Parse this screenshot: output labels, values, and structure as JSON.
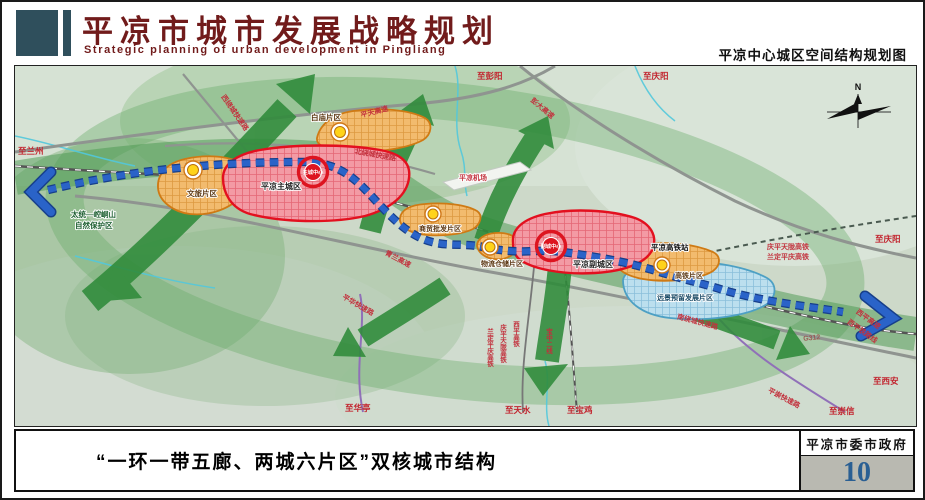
{
  "header": {
    "title": "平凉市城市发展战略规划",
    "subtitle_en": "Strategic planning of urban development in Pingliang",
    "right_caption": "平凉中心城区空间结构规划图"
  },
  "footer": {
    "caption": "“一环一带五廊、两城六片区”双核城市结构",
    "agency": "平凉市委市政府",
    "page_number": "10"
  },
  "map": {
    "compass_n": "N",
    "districts": [
      {
        "id": "baimiao",
        "label": "白庙片区",
        "type": "orange"
      },
      {
        "id": "wenlv",
        "label": "文旅片区",
        "type": "orange"
      },
      {
        "id": "zhucheng",
        "label": "平凉主城区",
        "type": "red"
      },
      {
        "id": "shangmao",
        "label": "商贸批发片区",
        "type": "orange"
      },
      {
        "id": "wuliu",
        "label": "物流仓储片区",
        "type": "orange"
      },
      {
        "id": "fucheng",
        "label": "平凉副城区",
        "type": "red"
      },
      {
        "id": "gaotie",
        "label": "高铁片区",
        "type": "orange"
      },
      {
        "id": "yuanjing",
        "label": "远景预留发展片区",
        "type": "blue"
      }
    ],
    "centers": [
      {
        "id": "main-core",
        "label": "主城中心"
      },
      {
        "id": "sub-core",
        "label": "副城中心"
      }
    ],
    "roads": [
      {
        "id": "xiraocheng",
        "label": "西绕城快速路"
      },
      {
        "id": "pingtian",
        "label": "平天高速"
      },
      {
        "id": "beiraocheng",
        "label": "北绕城快速路"
      },
      {
        "id": "pengda",
        "label": "彭大高速"
      },
      {
        "id": "qinglan",
        "label": "青兰高速"
      },
      {
        "id": "nanraocheng",
        "label": "南绕城快速路"
      },
      {
        "id": "pinghua",
        "label": "平华快速路"
      },
      {
        "id": "pingchong",
        "label": "平崇快速路"
      },
      {
        "id": "g312",
        "label": "G312"
      },
      {
        "id": "xiping-gs",
        "label": "西平高速"
      },
      {
        "id": "xiping-tl",
        "label": "西平铁路线"
      }
    ],
    "railways_ne": [
      {
        "label": "庆平天陇高铁"
      },
      {
        "label": "兰定平庆高铁"
      }
    ],
    "railways_s": [
      {
        "label": "兰定平庆高铁"
      },
      {
        "label": "庆平天陇高铁"
      },
      {
        "label": "西平高铁"
      },
      {
        "label": "宝中二线"
      }
    ],
    "directions": [
      {
        "id": "lanzhou",
        "label": "至兰州"
      },
      {
        "id": "pengyang",
        "label": "至彭阳"
      },
      {
        "id": "qingyang-top",
        "label": "至庆阳"
      },
      {
        "id": "qingyang-right",
        "label": "至庆阳"
      },
      {
        "id": "xian",
        "label": "至西安"
      },
      {
        "id": "chongxin",
        "label": "至崇信"
      },
      {
        "id": "baoji",
        "label": "至宝鸡"
      },
      {
        "id": "tianshui",
        "label": "至天水"
      },
      {
        "id": "huating",
        "label": "至华亭"
      }
    ],
    "pois": [
      {
        "id": "airport",
        "label": "平凉机场"
      },
      {
        "id": "hsr-station",
        "label": "平凉高铁站"
      },
      {
        "id": "reserve-1",
        "label": "太统—崆峒山"
      },
      {
        "id": "reserve-2",
        "label": "自然保护区"
      }
    ],
    "colors": {
      "title_maroon": "#711b1b",
      "header_block": "#2f4f5c",
      "page_number_blue": "#2a5f93",
      "axis_blue": "#2a63c8",
      "corridor_green": "#2f8b3a",
      "zone_red": "#e3101f",
      "zone_orange": "#cf7a14",
      "zone_blue": "#4da0c4",
      "node_yellow": "#ffd31a",
      "road_label_red": "#c2303c"
    }
  }
}
